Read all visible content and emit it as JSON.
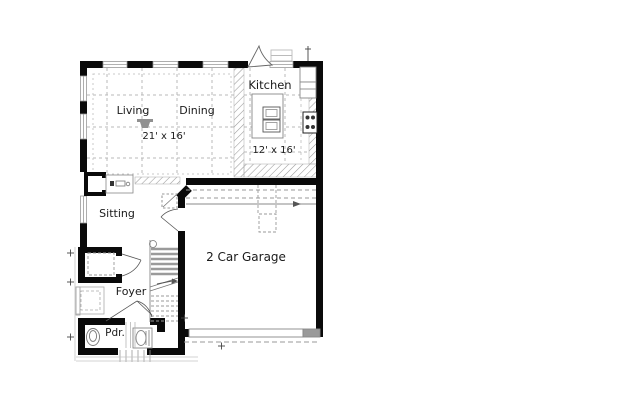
{
  "plan": {
    "title": "First floor plan",
    "rooms": [
      {
        "id": "living",
        "label": "Living"
      },
      {
        "id": "dining",
        "label": "Dining"
      },
      {
        "id": "kitchen",
        "label": "Kitchen"
      },
      {
        "id": "sitting",
        "label": "Sitting"
      },
      {
        "id": "garage",
        "label": "2 Car Garage"
      },
      {
        "id": "foyer",
        "label": "Foyer"
      },
      {
        "id": "powder",
        "label": "Pdr."
      }
    ],
    "dimensions": [
      {
        "id": "great-room",
        "label": "21' x 16'"
      },
      {
        "id": "kitchen",
        "label": "12' x 16'"
      }
    ],
    "colors": {
      "wall": "#0a0a0a",
      "hatch": "#999999",
      "grid": "#b9b9b9",
      "fixture": "#888888",
      "garage_door_panel": "#9a9a9a",
      "text": "#1a1a1a",
      "background": "#ffffff"
    },
    "fixtures": [
      "fireplace",
      "tv-niche",
      "kitchen-island",
      "range",
      "refrigerator-cabinet",
      "exterior-door",
      "stoop-steps",
      "staircase",
      "closet-shelf",
      "window-seat",
      "toilet",
      "pedestal-sink",
      "attic-access",
      "garage-door",
      "driveway-line",
      "interior-door-swings",
      "survey-markers"
    ]
  }
}
